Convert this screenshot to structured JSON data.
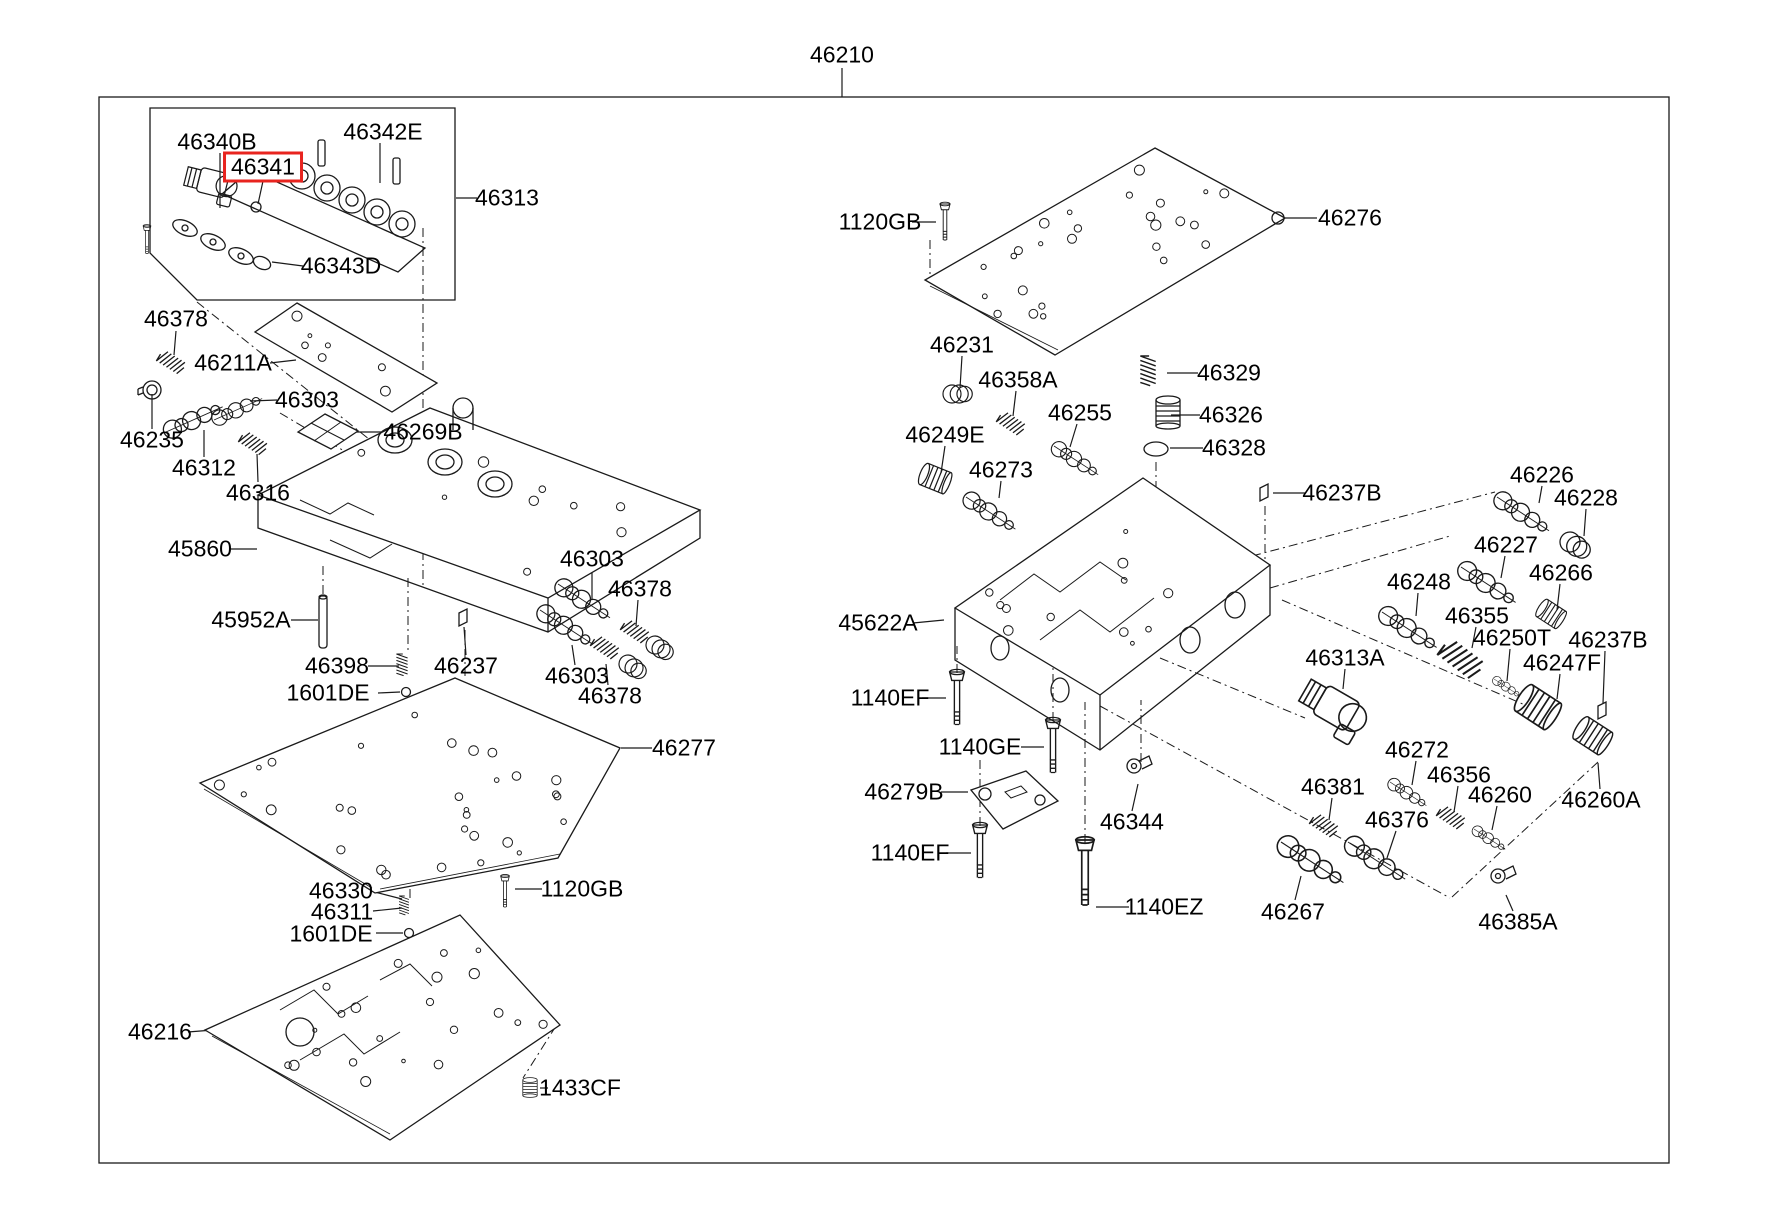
{
  "figure": {
    "assembly_callout": "46210",
    "highlighted_part": "46341",
    "colors": {
      "line": "#1a1a1a",
      "highlight": "#e8241f",
      "background": "#ffffff"
    }
  },
  "labels": [
    {
      "id": "46210",
      "text": "46210"
    },
    {
      "id": "46340B",
      "text": "46340B"
    },
    {
      "id": "46341",
      "text": "46341",
      "highlighted": true
    },
    {
      "id": "46342E",
      "text": "46342E"
    },
    {
      "id": "46313",
      "text": "46313"
    },
    {
      "id": "46343D",
      "text": "46343D"
    },
    {
      "id": "46378-1",
      "text": "46378"
    },
    {
      "id": "46211A",
      "text": "46211A"
    },
    {
      "id": "46303-1",
      "text": "46303"
    },
    {
      "id": "46235",
      "text": "46235"
    },
    {
      "id": "46312",
      "text": "46312"
    },
    {
      "id": "46316",
      "text": "46316"
    },
    {
      "id": "46269B",
      "text": "46269B"
    },
    {
      "id": "45860",
      "text": "45860"
    },
    {
      "id": "45952A",
      "text": "45952A"
    },
    {
      "id": "46398",
      "text": "46398"
    },
    {
      "id": "1601DE-1",
      "text": "1601DE"
    },
    {
      "id": "46237",
      "text": "46237"
    },
    {
      "id": "46303-2",
      "text": "46303"
    },
    {
      "id": "46378-2",
      "text": "46378"
    },
    {
      "id": "46303-3",
      "text": "46303"
    },
    {
      "id": "46378-3",
      "text": "46378"
    },
    {
      "id": "46277",
      "text": "46277"
    },
    {
      "id": "46330",
      "text": "46330"
    },
    {
      "id": "46311",
      "text": "46311"
    },
    {
      "id": "1601DE-2",
      "text": "1601DE"
    },
    {
      "id": "1120GB-2",
      "text": "1120GB"
    },
    {
      "id": "46216",
      "text": "46216"
    },
    {
      "id": "1433CF",
      "text": "1433CF"
    },
    {
      "id": "1120GB-1",
      "text": "1120GB"
    },
    {
      "id": "46276",
      "text": "46276"
    },
    {
      "id": "46231",
      "text": "46231"
    },
    {
      "id": "46358A",
      "text": "46358A"
    },
    {
      "id": "46255",
      "text": "46255"
    },
    {
      "id": "46329",
      "text": "46329"
    },
    {
      "id": "46326",
      "text": "46326"
    },
    {
      "id": "46328",
      "text": "46328"
    },
    {
      "id": "46249E",
      "text": "46249E"
    },
    {
      "id": "46273",
      "text": "46273"
    },
    {
      "id": "46237B-1",
      "text": "46237B"
    },
    {
      "id": "46226",
      "text": "46226"
    },
    {
      "id": "46228",
      "text": "46228"
    },
    {
      "id": "46227",
      "text": "46227"
    },
    {
      "id": "46266",
      "text": "46266"
    },
    {
      "id": "46248",
      "text": "46248"
    },
    {
      "id": "46355",
      "text": "46355"
    },
    {
      "id": "46250T",
      "text": "46250T"
    },
    {
      "id": "46237B-2",
      "text": "46237B"
    },
    {
      "id": "46247F",
      "text": "46247F"
    },
    {
      "id": "46313A",
      "text": "46313A"
    },
    {
      "id": "45622A",
      "text": "45622A"
    },
    {
      "id": "1140EF-1",
      "text": "1140EF"
    },
    {
      "id": "1140GE",
      "text": "1140GE"
    },
    {
      "id": "46279B",
      "text": "46279B"
    },
    {
      "id": "1140EF-2",
      "text": "1140EF"
    },
    {
      "id": "46344",
      "text": "46344"
    },
    {
      "id": "1140EZ",
      "text": "1140EZ"
    },
    {
      "id": "46267",
      "text": "46267"
    },
    {
      "id": "46272",
      "text": "46272"
    },
    {
      "id": "46356",
      "text": "46356"
    },
    {
      "id": "46260",
      "text": "46260"
    },
    {
      "id": "46260A",
      "text": "46260A"
    },
    {
      "id": "46381",
      "text": "46381"
    },
    {
      "id": "46376",
      "text": "46376"
    },
    {
      "id": "46385A",
      "text": "46385A"
    }
  ]
}
